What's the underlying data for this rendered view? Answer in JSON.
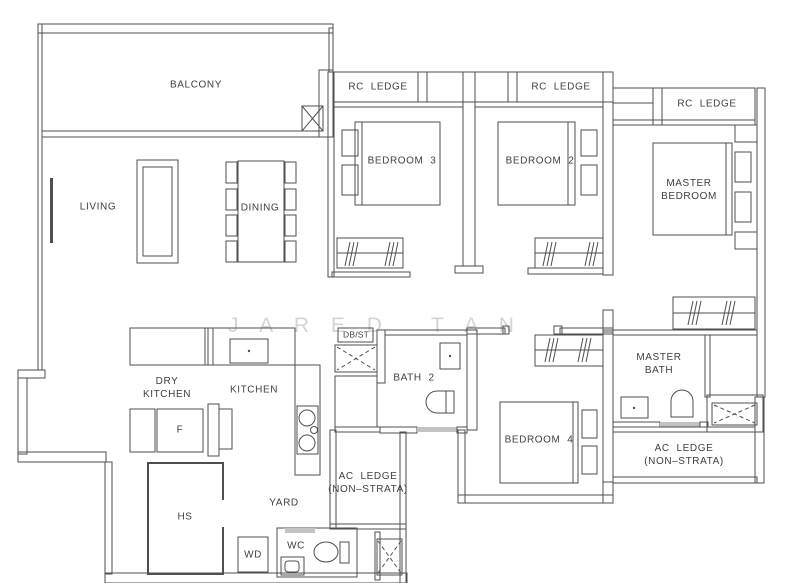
{
  "rooms": {
    "balcony": {
      "label": "BALCONY"
    },
    "living": {
      "label": "LIVING"
    },
    "dining": {
      "label": "DINING"
    },
    "bedroom3": {
      "label": "BEDROOM  3"
    },
    "bedroom2": {
      "label": "BEDROOM  2"
    },
    "bedroom4": {
      "label": "BEDROOM  4"
    },
    "master_bedroom": {
      "label": "MASTER\nBEDROOM"
    },
    "master_bath": {
      "label": "MASTER\nBATH"
    },
    "bath2": {
      "label": "BATH  2"
    },
    "dry_kitchen": {
      "label": "DRY\nKITCHEN"
    },
    "kitchen": {
      "label": "KITCHEN"
    },
    "yard": {
      "label": "YARD"
    },
    "hs": {
      "label": "HS"
    },
    "wc": {
      "label": "WC"
    },
    "wd": {
      "label": "WD"
    },
    "fridge": {
      "label": "F"
    },
    "db_st": {
      "label": "DB/ST"
    },
    "rc_ledge_1": {
      "label": "RC  LEDGE"
    },
    "rc_ledge_2": {
      "label": "RC  LEDGE"
    },
    "rc_ledge_3": {
      "label": "RC  LEDGE"
    },
    "ac_ledge_left": {
      "label": "AC  LEDGE\n(NON–STRATA)"
    },
    "ac_ledge_right": {
      "label": "AC  LEDGE\n(NON–STRATA)"
    }
  },
  "watermark": "J A R E D   T A N",
  "colors": {
    "wall_line": "#4f4f4f",
    "label_text": "#3f3f3f",
    "watermark": "#d4d4d4",
    "door_threshold": "#c2c2c2",
    "background": "#ffffff"
  }
}
